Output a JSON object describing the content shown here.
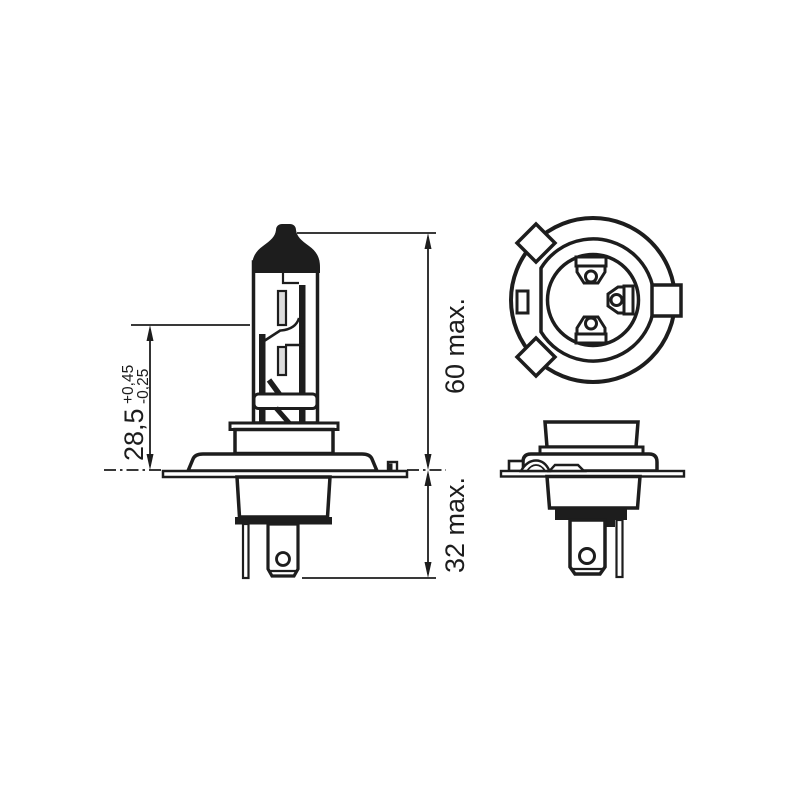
{
  "page": {
    "background": "#ffffff",
    "line_color": "#1d1d1d",
    "filament_fill": "#dcdcdc"
  },
  "drawing": {
    "dimensions": {
      "light_center_length": {
        "value": "28,5",
        "tolerance_plus": "+0,45",
        "tolerance_minus": "-0,25"
      },
      "overall_height": "60 max.",
      "base_height": "32 max."
    },
    "views": {
      "left": "bulb-side-view",
      "top_right": "base-top-view",
      "bottom_right": "base-side-view"
    }
  }
}
